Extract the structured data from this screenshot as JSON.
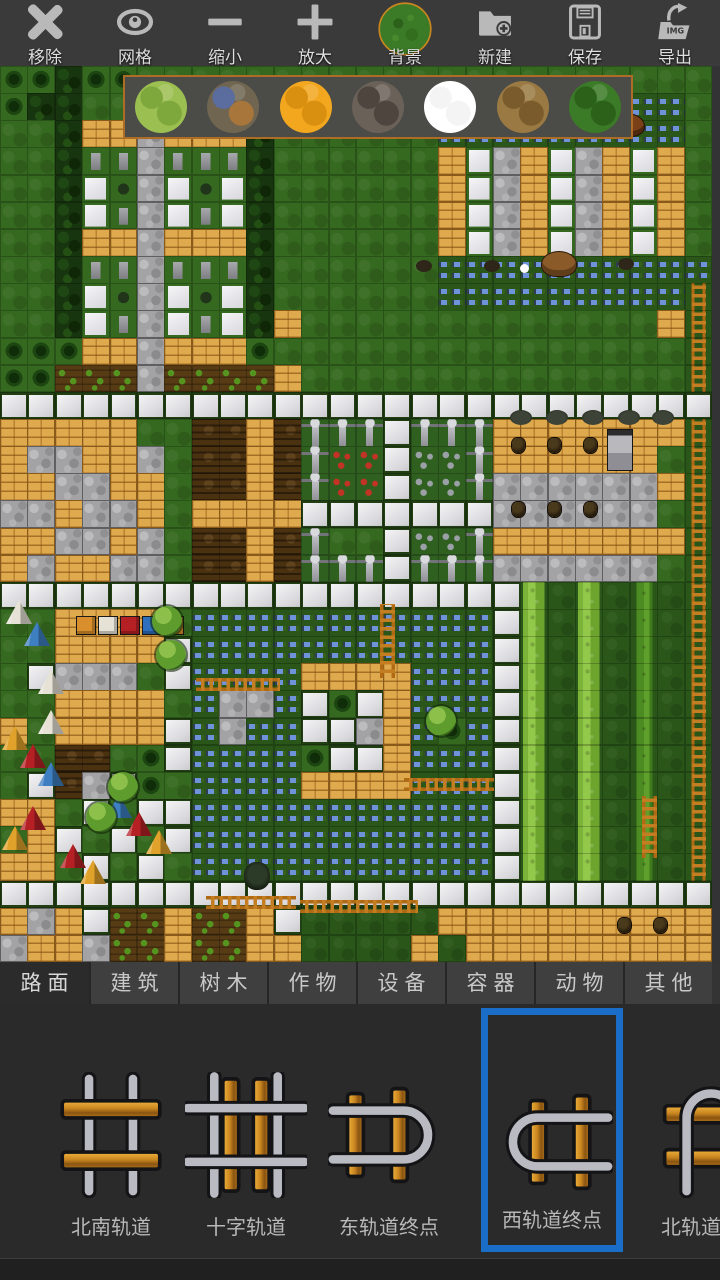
{
  "toolbar": {
    "items": [
      {
        "label": "移除",
        "icon": "remove-x-icon"
      },
      {
        "label": "网格",
        "icon": "grid-eye-icon"
      },
      {
        "label": "缩小",
        "icon": "zoom-out-minus-icon"
      },
      {
        "label": "放大",
        "icon": "zoom-in-plus-icon"
      },
      {
        "label": "背景",
        "icon": "background-texture-icon"
      },
      {
        "label": "新建",
        "icon": "new-folder-plus-icon"
      },
      {
        "label": "保存",
        "icon": "save-floppy-icon"
      },
      {
        "label": "导出",
        "icon": "export-img-icon",
        "badge": "IMG"
      }
    ]
  },
  "texture_picker": {
    "border_color": "#ad6d26",
    "swatches": [
      {
        "name": "light-grass",
        "base": "#9cbf52",
        "spot": "#7ea83c"
      },
      {
        "name": "water-rock",
        "base": "#6f6550",
        "spot": "#5a6d9e",
        "spot2": "#a8763a"
      },
      {
        "name": "orange-sand",
        "base": "#f2a71e",
        "spot": "#d98f10"
      },
      {
        "name": "dark-rock",
        "base": "#6a6158",
        "spot": "#4e463e"
      },
      {
        "name": "white",
        "base": "#ffffff",
        "spot": "#f4f4f4"
      },
      {
        "name": "dirt",
        "base": "#9a7a42",
        "spot": "#7a5c2c"
      },
      {
        "name": "dark-grass",
        "base": "#3b7a27",
        "spot": "#2c611a"
      }
    ]
  },
  "category_tabs": {
    "active_index": 0,
    "items": [
      "路面",
      "建筑",
      "树木",
      "作物",
      "设备",
      "容器",
      "动物",
      "其他"
    ]
  },
  "palette": {
    "selection_color": "#1a6ec8",
    "items": [
      {
        "label": "",
        "icon": "track-partial",
        "selected": false
      },
      {
        "label": "北南轨道",
        "icon": "track-ns",
        "selected": false
      },
      {
        "label": "十字轨道",
        "icon": "track-cross",
        "selected": false
      },
      {
        "label": "东轨道终点",
        "icon": "track-end-east",
        "selected": false
      },
      {
        "label": "西轨道终点",
        "icon": "track-end-west",
        "selected": true
      },
      {
        "label": "北轨道终点",
        "icon": "track-end-north",
        "selected": false
      }
    ]
  },
  "map": {
    "cols": 26,
    "rows": 33,
    "tiles": [
      "tthtt.....................",
      "thh...................www.",
      "..hbbsbbbh......wwwwwwwww.",
      "..hqqsqqqh......bBsbBsbBb.",
      "..hBusBuBh......bBsbBsbBb.",
      "..hBqsBqBh......bBsbBsbBb.",
      "..hbbsbbbh......bBsbBsbBb.",
      "..hqqsqqqh......wwwwwwwwww",
      "..hBusBuBh......wwwwwwwwwl",
      "..hBqsBqBhb.............bl",
      "tttbbsbbbt...............l",
      "ttcccsccccb..............l",
      "pppppppppppppppppppppppppp",
      "bbbbb..ddbdfffpfffbbbbbbbl",
      "bssbbs.ddbdfrrpggfbbbbbb.l",
      "bbssbb.ddbdfrrpggfssssssbl",
      "ssbssb.bbbbpppppppssssss.l",
      "bbssbs.ddbdf..pggfbbbbbbbl",
      "bsbbss.ddbdfffpfffssssss.l",
      "pppppppppppppppppppT,T,Y,l",
      "..bbbb.wwwwwwwwwwwpT,T,Y,l",
      "..bbbbpwwwwwwwwwwwpT,T,Y,l",
      ".psss.pwwwwbbbbwwwpT,T,Y,l",
      "..bbbb.wsswptpbwwwpT,T,Y,l",
      "b.bbbbpwswwppsbwtwpT,T,Y,l",
      "..dd.tpwwwwtppbwwwpT,T,Y,l",
      ".pdspt.wwwwbbbbwwwpT,T,Y,l",
      "bb.p.ppwwwwwwwwwwwpT,T,Y,l",
      ".bp.p.pwwwwwwwwwwwpT,T,Y,l",
      "bb.p.p.wwwwwwwwwwwpT,T,Y,l",
      "pppppppppppppppppppppppppp",
      "bsbpccbccbp,,,,,bbbbbbbbbb",
      "sbbsccbccbb,,,,b,bbbbbbbbb"
    ],
    "tents": [
      {
        "c": "#e6e2d6",
        "x": 6,
        "y": 534
      },
      {
        "c": "#3d7fc1",
        "x": 24,
        "y": 556
      },
      {
        "c": "#e6e2d6",
        "x": 38,
        "y": 604
      },
      {
        "c": "#e6e2d6",
        "x": 38,
        "y": 644
      },
      {
        "c": "#e0a22a",
        "x": 2,
        "y": 660
      },
      {
        "c": "#b52025",
        "x": 20,
        "y": 678
      },
      {
        "c": "#3d7fc1",
        "x": 38,
        "y": 696
      },
      {
        "c": "#b52025",
        "x": 20,
        "y": 740
      },
      {
        "c": "#e0a22a",
        "x": 2,
        "y": 760
      },
      {
        "c": "#3d7fc1",
        "x": 106,
        "y": 728
      },
      {
        "c": "#b52025",
        "x": 126,
        "y": 746
      },
      {
        "c": "#e0a22a",
        "x": 146,
        "y": 764
      },
      {
        "c": "#b52025",
        "x": 60,
        "y": 778
      },
      {
        "c": "#e0a22a",
        "x": 80,
        "y": 794
      }
    ],
    "square_tents": [
      {
        "c": "#d98f2b",
        "x": 76,
        "y": 550
      },
      {
        "c": "#e6e2d6",
        "x": 98,
        "y": 550
      },
      {
        "c": "#b52025",
        "x": 120,
        "y": 550
      },
      {
        "c": "#2e6fbe",
        "x": 142,
        "y": 550
      },
      {
        "c": "#d98f2b",
        "x": 164,
        "y": 550
      }
    ],
    "trees": [
      {
        "x": 152,
        "y": 540
      },
      {
        "x": 156,
        "y": 574
      },
      {
        "x": 108,
        "y": 706
      },
      {
        "x": 86,
        "y": 736
      },
      {
        "x": 426,
        "y": 640
      }
    ],
    "animals": [
      {
        "t": "horse",
        "x": 612,
        "y": 48
      },
      {
        "t": "bear",
        "x": 542,
        "y": 186
      },
      {
        "t": "small",
        "x": 416,
        "y": 194
      },
      {
        "t": "small",
        "x": 484,
        "y": 194
      },
      {
        "t": "small",
        "x": 618,
        "y": 192
      },
      {
        "t": "dot",
        "x": 520,
        "y": 198
      }
    ],
    "ladders": [
      {
        "o": "v",
        "x": 380,
        "y": 538,
        "len": 74
      },
      {
        "o": "h",
        "x": 196,
        "y": 612,
        "len": 84
      },
      {
        "o": "h",
        "x": 404,
        "y": 712,
        "len": 90
      },
      {
        "o": "v",
        "x": 642,
        "y": 730,
        "len": 62
      },
      {
        "o": "h",
        "x": 206,
        "y": 830,
        "len": 90
      },
      {
        "o": "h",
        "x": 300,
        "y": 834,
        "len": 118
      }
    ],
    "pots": [
      {
        "x": 512,
        "y": 372
      },
      {
        "x": 548,
        "y": 372
      },
      {
        "x": 584,
        "y": 372
      },
      {
        "x": 512,
        "y": 436
      },
      {
        "x": 548,
        "y": 436
      },
      {
        "x": 584,
        "y": 436
      },
      {
        "x": 618,
        "y": 852
      },
      {
        "x": 654,
        "y": 852
      }
    ],
    "shrub_piles": [
      {
        "x": 510,
        "y": 344
      },
      {
        "x": 546,
        "y": 344
      },
      {
        "x": 582,
        "y": 344
      },
      {
        "x": 618,
        "y": 344
      },
      {
        "x": 652,
        "y": 344
      }
    ],
    "well": {
      "x": 608,
      "y": 364
    },
    "road_tree": {
      "x": 244,
      "y": 796
    }
  }
}
